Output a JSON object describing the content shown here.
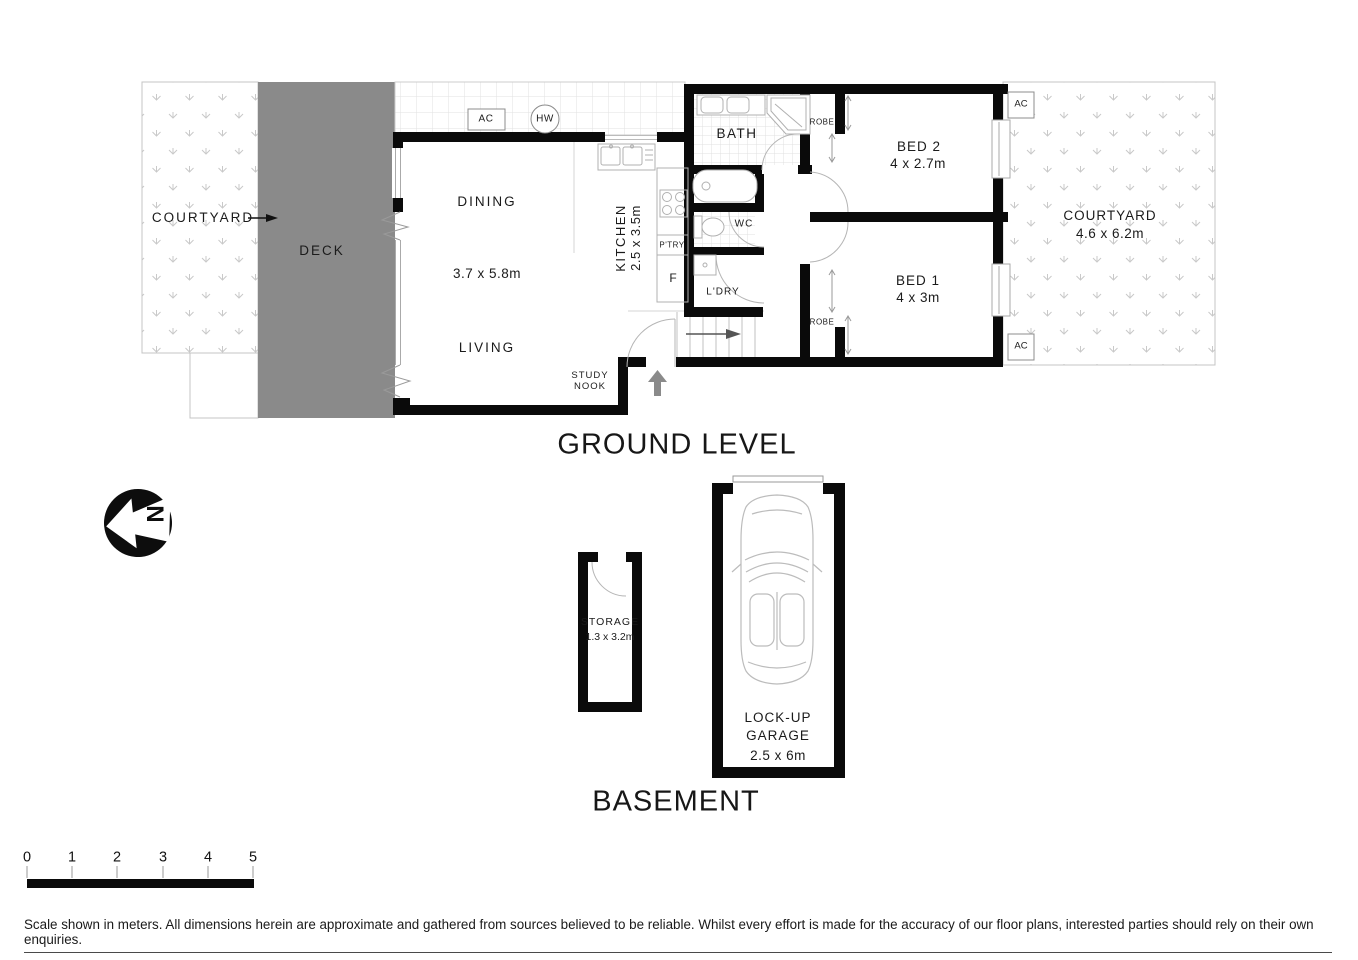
{
  "ground_level": {
    "heading": "GROUND LEVEL",
    "courtyard_left": {
      "label": "COURTYARD"
    },
    "deck": {
      "label": "DECK"
    },
    "dining": {
      "label": "DINING"
    },
    "living": {
      "label": "LIVING"
    },
    "living_dining_dims": "3.7 x 5.8m",
    "study_nook": {
      "line1": "STUDY",
      "line2": "NOOK"
    },
    "kitchen": {
      "label": "KITCHEN",
      "dims": "2.5 x 3.5m"
    },
    "pantry": {
      "label": "P'TRY"
    },
    "fridge": {
      "label": "F"
    },
    "bath": {
      "label": "BATH"
    },
    "wc": {
      "label": "WC"
    },
    "laundry": {
      "label": "L'DRY"
    },
    "bed2": {
      "label": "BED 2",
      "dims": "4 x 2.7m",
      "robe": "ROBE"
    },
    "bed1": {
      "label": "BED 1",
      "dims": "4 x 3m",
      "robe": "ROBE"
    },
    "courtyard_right": {
      "label": "COURTYARD",
      "dims": "4.6 x 6.2m"
    },
    "equipment": {
      "ac_top": "AC",
      "hw": "HW",
      "ac_right_top": "AC",
      "ac_right_bottom": "AC"
    }
  },
  "basement": {
    "heading": "BASEMENT",
    "storage": {
      "label": "STORAGE",
      "dims": "1.3 x 3.2m"
    },
    "garage": {
      "line1": "LOCK-UP",
      "line2": "GARAGE",
      "dims": "2.5 x 6m"
    }
  },
  "compass": {
    "north": "N"
  },
  "scale_bar": {
    "ticks": [
      "0",
      "1",
      "2",
      "3",
      "4",
      "5"
    ]
  },
  "footer": {
    "disclaimer": "Scale shown in meters. All dimensions herein are approximate and gathered from sources believed to be reliable. Whilst every effort is made for the accuracy of our floor plans, interested parties should rely on their own enquiries."
  },
  "colors": {
    "wall": "#0a0a0a",
    "deck": "#8a8a8a",
    "pattern": "#c6c6c6",
    "thin_line": "#b5b5b5",
    "gray_arrow": "#8a8a8a"
  }
}
